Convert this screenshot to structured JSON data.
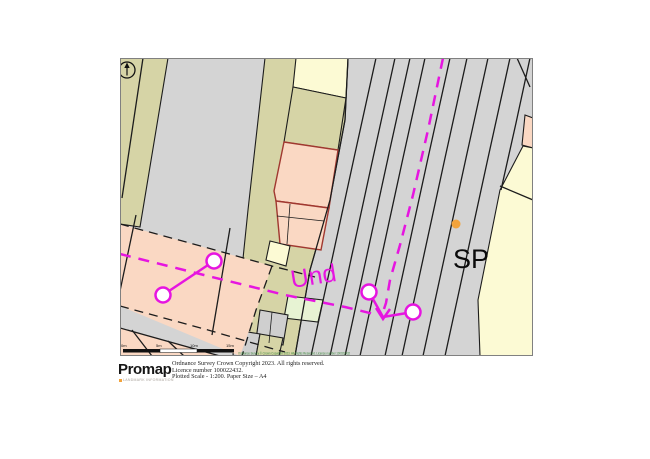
{
  "colors": {
    "grey": "#d4d4d4",
    "grey2": "#cfcfcf",
    "khaki": "#d6d4a6",
    "salmon": "#fad8c3",
    "paleyellow": "#fcfad4",
    "palegreen": "#e7f3d3",
    "darkred": "#a03830",
    "magenta": "#e615e0",
    "orange": "#f2a33c",
    "line": "#1c1c1c",
    "copyrightgreen": "#3c8a3c"
  },
  "icons": {
    "north_arrow": "north-arrow-icon",
    "survey_node": "survey-node-icon",
    "boundary_arrow": "boundary-arrow-icon"
  },
  "map": {
    "labels": {
      "und": "Und",
      "sp": "SP"
    },
    "scale_bar": {
      "labels": [
        "0m",
        "5m",
        "10m",
        "15m"
      ]
    },
    "copyright": "Ordnance Survey © Crown Copyright 2023. All Rights Reserved. Licence number 100022432"
  },
  "footer": {
    "logo": "Promap",
    "tagline": "LANDMARK INFORMATION",
    "lines": [
      "Ordnance Survey Crown Copyright 2023. All rights reserved.",
      "Licence number 100022432.",
      "Plotted Scale - 1:200. Paper Size – A4"
    ]
  }
}
